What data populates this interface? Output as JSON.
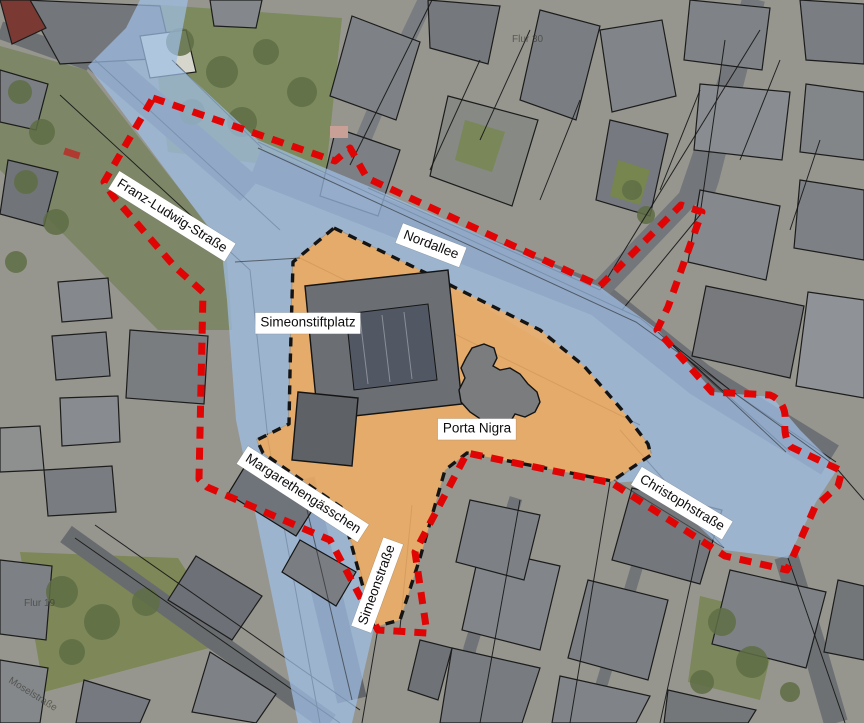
{
  "map": {
    "street_labels": [
      {
        "id": "franz-ludwig-strasse",
        "text": "Franz-Ludwig-Straße"
      },
      {
        "id": "nordallee",
        "text": "Nordallee"
      },
      {
        "id": "simeonstiftplatz",
        "text": "Simeonstiftplatz"
      },
      {
        "id": "porta-nigra",
        "text": "Porta Nigra"
      },
      {
        "id": "margarethengaesschen",
        "text": "Margarethengässchen"
      },
      {
        "id": "simeonstrasse",
        "text": "Simeonstraße"
      },
      {
        "id": "christophstrasse",
        "text": "Christophstraße"
      }
    ],
    "cadastral_labels": [
      {
        "id": "flur-30",
        "text": "Flur 30"
      },
      {
        "id": "flur-19",
        "text": "Flur 19"
      },
      {
        "id": "moselstrasse",
        "text": "Moselstraße"
      }
    ],
    "overlays": {
      "street_space": {
        "color": "#9fbfe6"
      },
      "pedestrian_zone": {
        "color": "#efae67",
        "outline_color": "#141414",
        "outline_style": "dashed"
      },
      "study_area_boundary": {
        "color": "#e00404",
        "style": "dashed"
      }
    }
  }
}
